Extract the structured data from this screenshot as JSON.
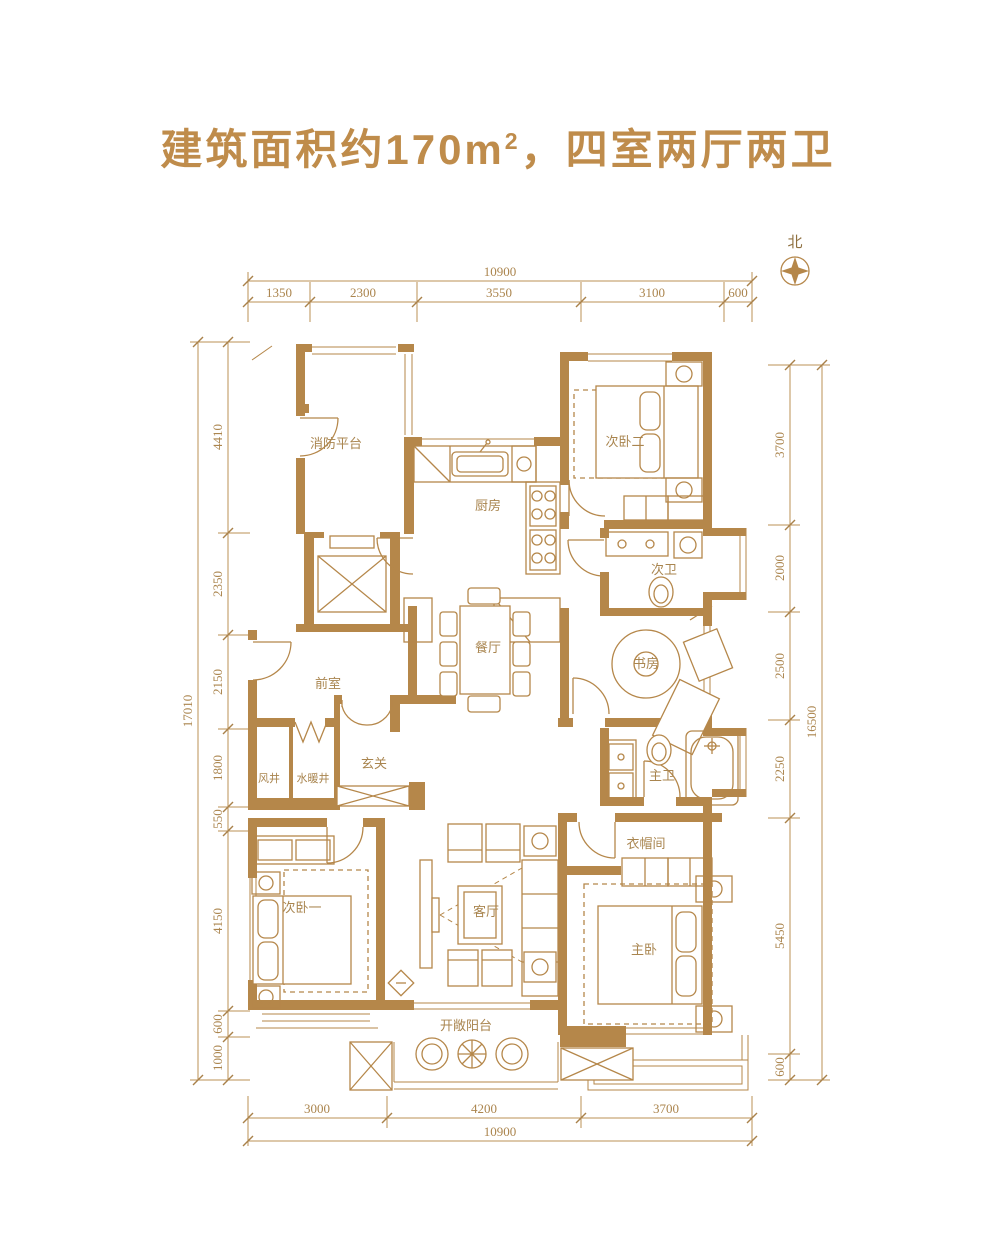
{
  "title": {
    "part1": "建筑面积约170m",
    "sup": "2",
    "part2": "，四室两厅两卫"
  },
  "north": {
    "label": "北"
  },
  "rooms": {
    "fire_platform": "消防平台",
    "kitchen": "厨房",
    "bedroom2": "次卧二",
    "bath2": "次卫",
    "dining": "餐厅",
    "study": "书房",
    "front_room": "前室",
    "foyer": "玄关",
    "air_shaft": "风井",
    "plumbing_shaft": "水暖井",
    "master_bath": "主卫",
    "cloakroom": "衣帽间",
    "bedroom1": "次卧一",
    "living": "客厅",
    "master_bedroom": "主卧",
    "balcony": "开敞阳台"
  },
  "dimensions": {
    "top": {
      "total": "10900",
      "segments": [
        "1350",
        "2300",
        "3550",
        "3100",
        "600"
      ]
    },
    "bottom": {
      "total": "10900",
      "segments": [
        "3000",
        "4200",
        "3700"
      ]
    },
    "left": {
      "total": "17010",
      "segments": [
        "4410",
        "2350",
        "2150",
        "1800",
        "550",
        "4150",
        "600",
        "1000"
      ]
    },
    "right": {
      "total": "16500",
      "segments": [
        "3700",
        "2000",
        "2500",
        "2250",
        "5450",
        "600"
      ]
    }
  },
  "colors": {
    "wall": "#b5874a",
    "dim_text": "#ab854e",
    "title": "#bf8c4b"
  }
}
